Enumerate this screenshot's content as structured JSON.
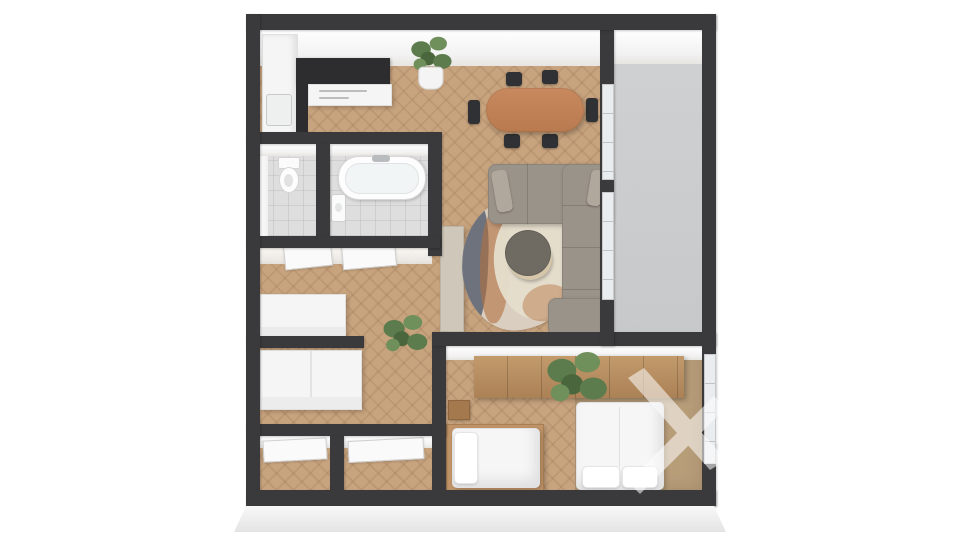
{
  "scene": {
    "type": "3d-floor-plan-render",
    "view": "top-down 3D dollhouse render of a two-bedroom apartment, no visible text",
    "background": "#ffffff"
  },
  "colors": {
    "wall": "#3a3a3c",
    "wood": "#c7a37e",
    "tile": "#dedede",
    "balcony": "#c6c8ca",
    "sofa": "#9a9389",
    "chair": "#2f3134",
    "tablewood": "#c9895f",
    "tablewood2": "#b97a50",
    "rugbase": "#d9cec0",
    "rugslate": "#5b6270",
    "rugrust": "#b3713f",
    "rugcore": "#e6ddcc",
    "wardrobe1": "#c29a6b",
    "wardrobe2": "#ab8156",
    "carpet": "#b89d79",
    "plant1": "#5d7c4d",
    "plant2": "#6f8f5b",
    "plant3": "#49663c",
    "counterdark": "#2d2d30",
    "whitef": "#f5f5f5",
    "tan": "#c09468",
    "coffeetop": "#6f6b63",
    "coffeebase": "#d6c7ab",
    "watermark": "#ffffff"
  },
  "rooms": [
    {
      "id": "kitchen",
      "name": "open kitchen",
      "furniture": [
        "l-shaped-counter-dark-top",
        "white-base-cabinets",
        "sink",
        "potted-plant"
      ]
    },
    {
      "id": "dining",
      "name": "dining area",
      "furniture": [
        "oval-wood-table",
        "six-black-chairs"
      ]
    },
    {
      "id": "living",
      "name": "living area",
      "furniture": [
        "corner-sofa-gray",
        "area-rug",
        "round-coffee-table",
        "sideboard"
      ]
    },
    {
      "id": "balcony",
      "name": "balcony",
      "furniture": []
    },
    {
      "id": "wc",
      "name": "toilet room",
      "furniture": [
        "toilet"
      ]
    },
    {
      "id": "bathroom",
      "name": "bathroom",
      "furniture": [
        "bathtub",
        "wash-basin"
      ]
    },
    {
      "id": "hallway",
      "name": "hallway",
      "furniture": [
        "low-wardrobe",
        "two-open-doors",
        "potted-plant"
      ]
    },
    {
      "id": "dressing",
      "name": "storage / dressing room",
      "furniture": [
        "large-white-wardrobe"
      ]
    },
    {
      "id": "closet-1",
      "name": "storage closet",
      "furniture": [
        "door"
      ]
    },
    {
      "id": "closet-2",
      "name": "storage closet",
      "furniture": [
        "door"
      ]
    },
    {
      "id": "bedroom",
      "name": "bedroom",
      "furniture": [
        "long-wood-wardrobe",
        "double-bed",
        "single-bed",
        "nightstand",
        "potted-plant",
        "window"
      ]
    }
  ],
  "watermark": {
    "present": true,
    "description": "translucent white logo mark over bedroom right side"
  }
}
